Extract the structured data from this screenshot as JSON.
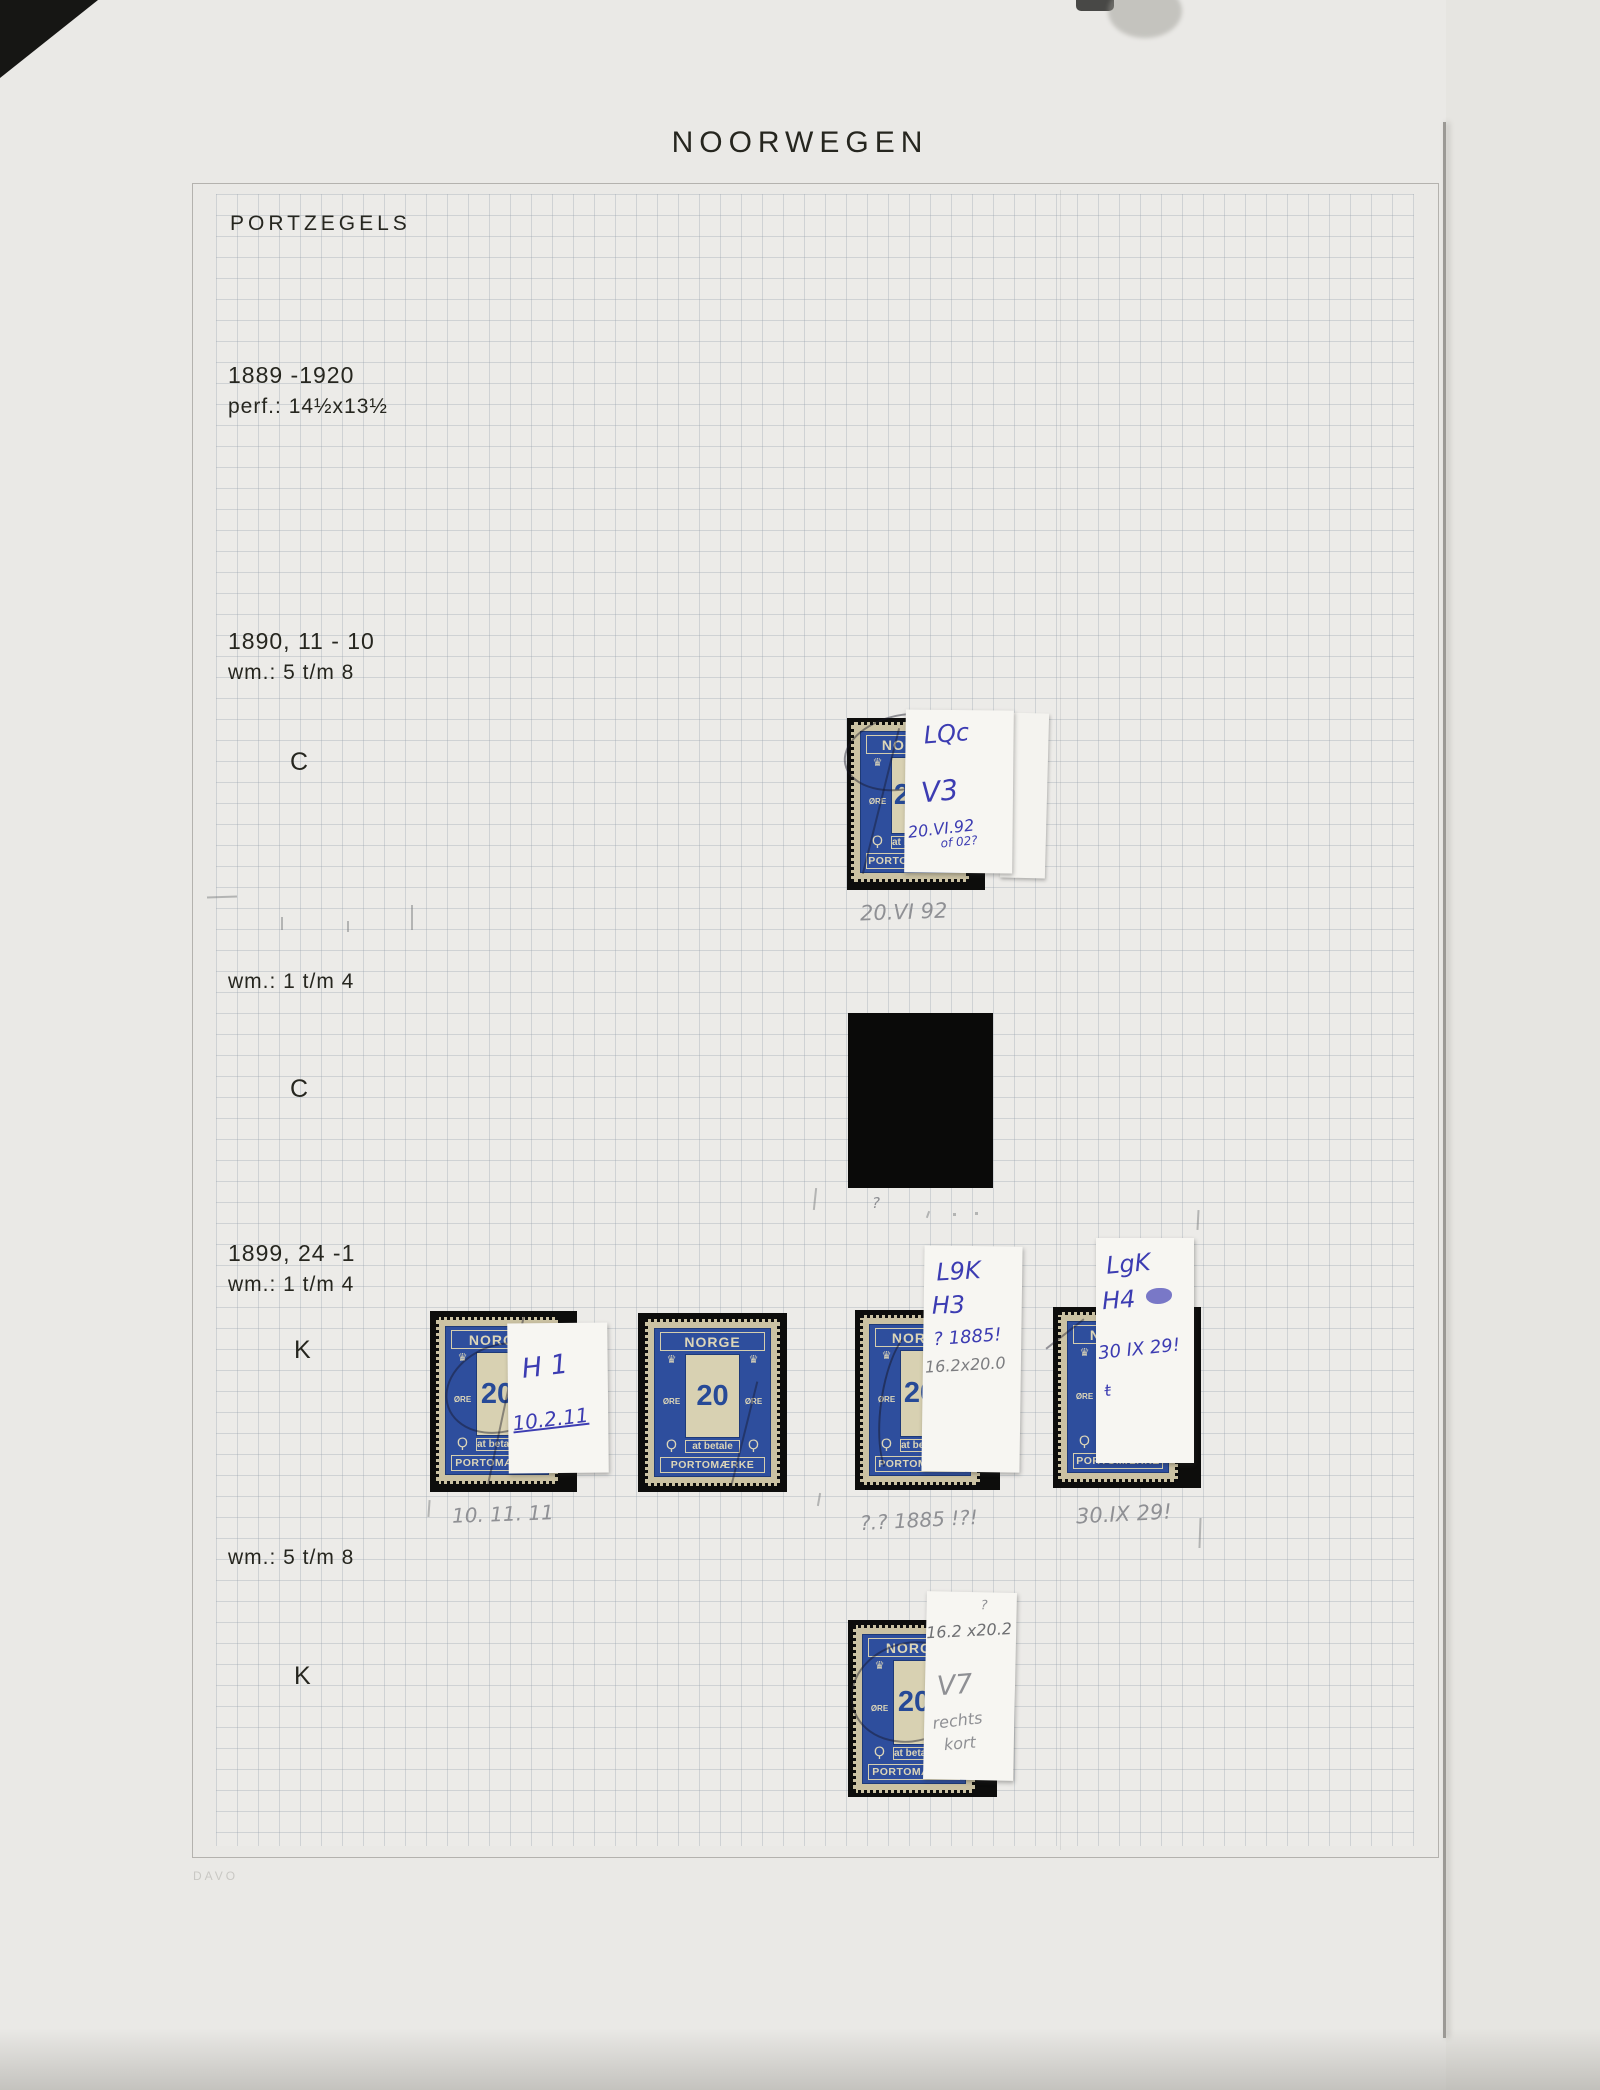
{
  "header": {
    "title": "NOORWEGEN",
    "heading": "PORTZEGELS"
  },
  "intro": {
    "period": "1889 -1920",
    "perf": "perf.: 14½x13½"
  },
  "s1890": {
    "issue": "1890, 11 - 10",
    "wm": "wm.: 5 t/m 8",
    "type": "C"
  },
  "s1890b": {
    "wm": "wm.: 1 t/m 4",
    "type": "C"
  },
  "s1899": {
    "issue": "1899, 24 -1",
    "wm": "wm.: 1 t/m 4",
    "type": "K"
  },
  "s1899b": {
    "wm": "wm.: 5 t/m 8",
    "type": "K"
  },
  "stamp_face": {
    "country": "NORGE",
    "value": "20",
    "currency": "ØRE",
    "due": "at betale",
    "footer": "PORTOMÆRKE"
  },
  "icons": {
    "crown": "♛",
    "posthorn": "Ϙ"
  },
  "notes": {
    "c1890": {
      "line1": "LQc",
      "line2": "V3",
      "line3": "20.VI.92",
      "line4": "of 02?",
      "caption": "20.VI 92"
    },
    "k1": {
      "line1": "H 1",
      "line2": "10.2.11",
      "caption": "10. 11. 11"
    },
    "k3": {
      "line1": "L9K",
      "line2": "H3",
      "line3": "? 1885!",
      "line4": "16.2x20.0",
      "caption": "?.? 1885 !?!"
    },
    "k4": {
      "line1": "LgK",
      "line2": "H4",
      "line3": "30 IX 29!",
      "line4": "t",
      "caption": "30.IX 29!"
    },
    "k5": {
      "line1": "?",
      "line2": "16.2 x20.2",
      "line3": "V7",
      "line4": "rechts",
      "line5": "kort"
    }
  },
  "marks": {
    "query": "?"
  },
  "footer": {
    "brand": "DAVO"
  }
}
